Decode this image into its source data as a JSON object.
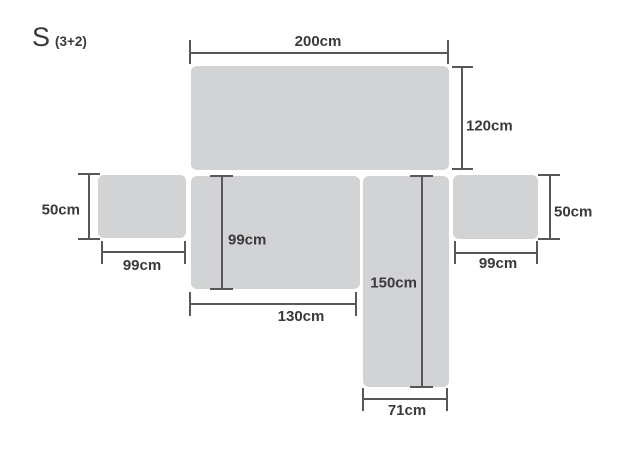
{
  "title": {
    "main": "S",
    "suffix": "(3+2)"
  },
  "colors": {
    "background": "#ffffff",
    "panel_fill": "#d2d3d5",
    "line": "#58585b",
    "text": "#3a3a3c"
  },
  "panels": [
    {
      "name": "backrest-panel"
    },
    {
      "name": "left-armrest-panel"
    },
    {
      "name": "seat-panel"
    },
    {
      "name": "chaise-panel"
    },
    {
      "name": "right-armrest-panel"
    }
  ],
  "dimensions": {
    "top_width": "200cm",
    "back_depth": "120cm",
    "left_arm_height": "50cm",
    "left_arm_width": "99cm",
    "seat_depth": "99cm",
    "seat_width": "130cm",
    "chaise_length": "150cm",
    "chaise_width": "71cm",
    "right_arm_width": "99cm",
    "right_arm_height": "50cm"
  }
}
